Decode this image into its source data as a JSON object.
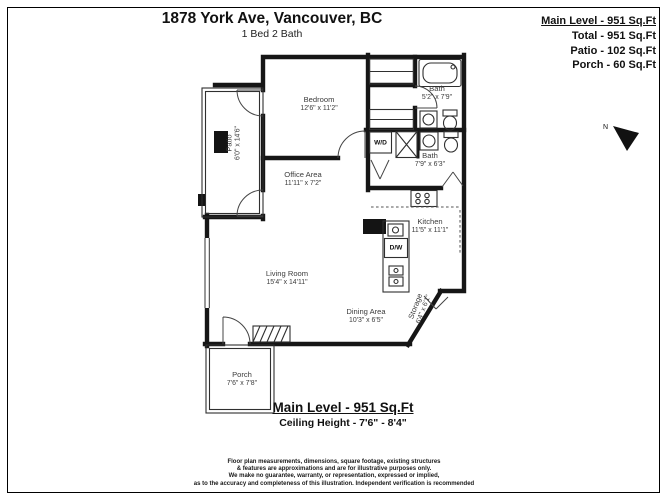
{
  "header": {
    "title": "1878 York Ave, Vancouver, BC",
    "subtitle": "1 Bed 2 Bath"
  },
  "summary": {
    "main_level": "Main Level - 951 Sq.Ft",
    "total": "Total - 951 Sq.Ft",
    "patio": "Patio - 102 Sq.Ft",
    "porch": "Porch - 60 Sq.Ft"
  },
  "compass": {
    "north_label": "N"
  },
  "rooms": {
    "bedroom": {
      "name": "Bedroom",
      "dims": "12'6\" x 11'2\""
    },
    "bath_upper": {
      "name": "Bath",
      "dims": "5'2\" x 7'9\""
    },
    "patio": {
      "name": "Patio",
      "dims": "6'0\" x 14'6\""
    },
    "laundry": {
      "label": "W/D"
    },
    "bath_lower": {
      "name": "Bath",
      "dims": "7'9\" x 6'3\""
    },
    "office": {
      "name": "Office Area",
      "dims": "11'11\" x 7'2\""
    },
    "kitchen": {
      "name": "Kitchen",
      "dims": "11'5\" x 11'1\""
    },
    "dishwasher": {
      "label": "D/W"
    },
    "living": {
      "name": "Living Room",
      "dims": "15'4\" x 14'11\""
    },
    "dining": {
      "name": "Dining Area",
      "dims": "10'3\" x 6'5\""
    },
    "storage": {
      "name": "Storage",
      "dims": "6'4\" x 6'1\""
    },
    "porch": {
      "name": "Porch",
      "dims": "7'6\" x 7'8\""
    }
  },
  "footer": {
    "main_level": "Main Level - 951 Sq.Ft",
    "ceiling_height": "Ceiling Height - 7'6\" - 8'4\""
  },
  "disclaimer": {
    "line1": "Floor plan measurements, dimensions, square footage, existing structures",
    "line2": "& features are approximations and are for illustrative purposes only.",
    "line3": "We make no guarantee, warranty, or representation, expressed or implied,",
    "line4": "as to the accuracy and completeness of this illustration. Independent verification is recommended"
  },
  "colors": {
    "wall": "#161616",
    "text": "#3c3c3c",
    "background": "#ffffff"
  }
}
